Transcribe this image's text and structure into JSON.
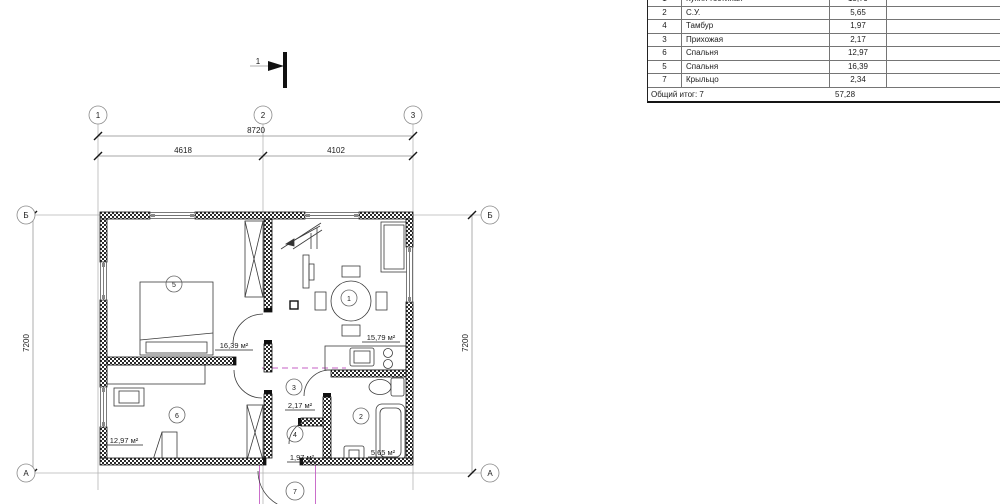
{
  "table": {
    "rows": [
      {
        "num": "1",
        "name": "Кухня-гостиная",
        "area": "15,79"
      },
      {
        "num": "2",
        "name": "С.У.",
        "area": "5,65"
      },
      {
        "num": "4",
        "name": "Тамбур",
        "area": "1,97"
      },
      {
        "num": "3",
        "name": "Прихожая",
        "area": "2,17"
      },
      {
        "num": "6",
        "name": "Спальня",
        "area": "12,97"
      },
      {
        "num": "5",
        "name": "Спальня",
        "area": "16,39"
      },
      {
        "num": "7",
        "name": "Крыльцо",
        "area": "2,34"
      }
    ],
    "footer": {
      "label": "Общий итог: 7",
      "total": "57,28"
    }
  },
  "dims": {
    "overall": "8720",
    "span_left": "4618",
    "span_right": "4102",
    "height_left": "7200",
    "height_right": "7200"
  },
  "axes": {
    "v1": "1",
    "v2": "2",
    "v3": "3",
    "hb": "Б",
    "ha": "А"
  },
  "section": {
    "label": "1"
  },
  "rooms": [
    {
      "num": "5",
      "area_label": "16,39 м²"
    },
    {
      "num": "1",
      "area_label": "15,79 м²"
    },
    {
      "num": "6",
      "area_label": "12,97 м²"
    },
    {
      "num": "3",
      "area_label": "2,17 м²"
    },
    {
      "num": "4",
      "area_label": "1,97 м²"
    },
    {
      "num": "2",
      "area_label": "5,65 м²"
    },
    {
      "num": "7",
      "area_label": "2,34 м²"
    }
  ],
  "colors": {
    "line": "#1c1c1c",
    "construction": "#b5b5b5",
    "magenta": "#c45fc4"
  }
}
